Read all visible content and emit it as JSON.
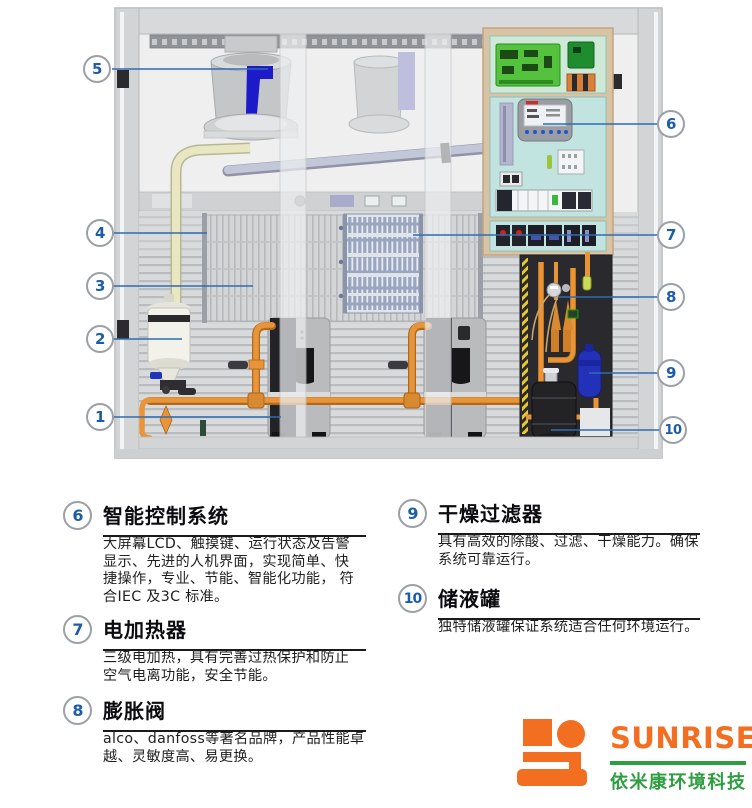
{
  "diagram": {
    "callouts": [
      {
        "number": "5"
      },
      {
        "number": "4"
      },
      {
        "number": "3"
      },
      {
        "number": "2"
      },
      {
        "number": "1"
      },
      {
        "number": "6"
      },
      {
        "number": "7"
      },
      {
        "number": "8"
      },
      {
        "number": "9"
      },
      {
        "number": "10"
      }
    ],
    "parts": {
      "fan": "离心风机",
      "heater": "电加热器",
      "humidifier": "加湿罐",
      "compressor": "压缩机",
      "control_panel": "电控箱",
      "drier_filter": "干燥过滤器",
      "receiver": "储液罐"
    }
  },
  "sections": [
    {
      "number": "6",
      "title": "智能控制系统",
      "body": "大屏幕LCD、触摸键、运行状态及告警\n显示、先进的人机界面，实现简单、快\n捷操作，专业、节能、智能化功能， 符\n合IEC 及3C 标准。"
    },
    {
      "number": "7",
      "title": "电加热器",
      "body": "三级电加热，具有完善过热保护和防止\n空气电离功能，安全节能。"
    },
    {
      "number": "8",
      "title": "膨胀阀",
      "body": "alco、danfoss等著名品牌，产品性能卓\n越、灵敏度高、易更换。"
    },
    {
      "number": "9",
      "title": "干燥过滤器",
      "body": "具有高效的除酸、过滤、干燥能力。确保\n系统可靠运行。"
    },
    {
      "number": "10",
      "title": "储液罐",
      "body": "独特储液罐保证系统适合任何环境运行。"
    }
  ],
  "logo": {
    "brand": "SUNRISE",
    "company": "依米康环境科技",
    "orange": "#f26f21",
    "green": "#2f9e41"
  },
  "colors": {
    "callout_number": "#1c5ca8",
    "callout_ring": "#9aa0a5",
    "leader_line": "#2e6cb2",
    "copper_pipe": "#e08a30",
    "panel_beige": "#d9c3a5",
    "panel_cyan": "#c2e4e0",
    "pcb_green": "#55c23e",
    "drier_blue": "#2331b8",
    "fan_blade_blue": "#1d1bc9"
  }
}
